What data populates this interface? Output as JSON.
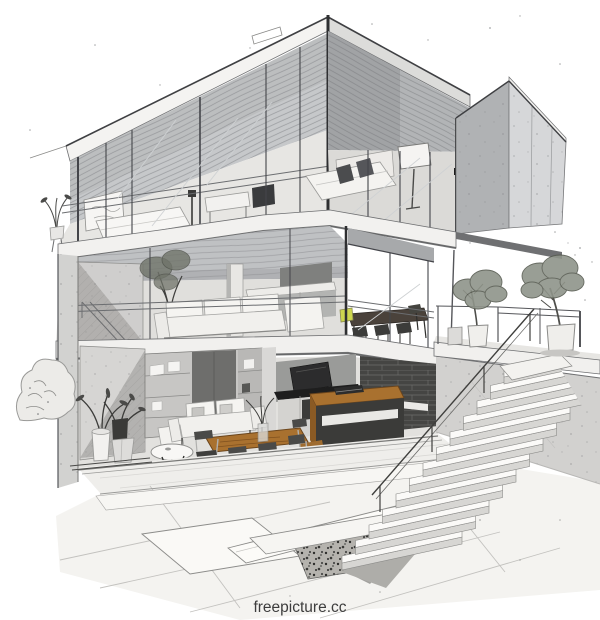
{
  "scene": {
    "type": "architectural-sketch-illustration",
    "description": "Monochrome pencil-style cutaway illustration of a modern three-storey glass and concrete house: top-floor bedroom with balcony and cantilevered concrete box, middle-floor living room with sectional sofa, kitchen and dining set, ground-floor lounge with wood furniture and kitchen island, exterior concrete staircase with cable railing, terrace with two potted trees, and a paved patio with a gravel inset in the foreground."
  },
  "watermark": {
    "text": "freepicture.cc",
    "color": "#3d3d3d"
  },
  "palette": {
    "background": "#ffffff",
    "ink": "#3f4043",
    "concrete_light": "#d6d7d9",
    "concrete_mid": "#b2b4b6",
    "concrete_dark": "#8e8e8c",
    "interior_wall": "#e3e2df",
    "glass_reflection": "#ced1d3",
    "wood_top": "#a9712f",
    "wood_front": "#8a5a24",
    "counter_black": "#1e1e1e",
    "brick_dark": "#454543",
    "foliage": "#8f948a",
    "chair_yellow": "#cdd64f",
    "paving": "#f4f3f0",
    "gravel": "#b5b3ae"
  }
}
